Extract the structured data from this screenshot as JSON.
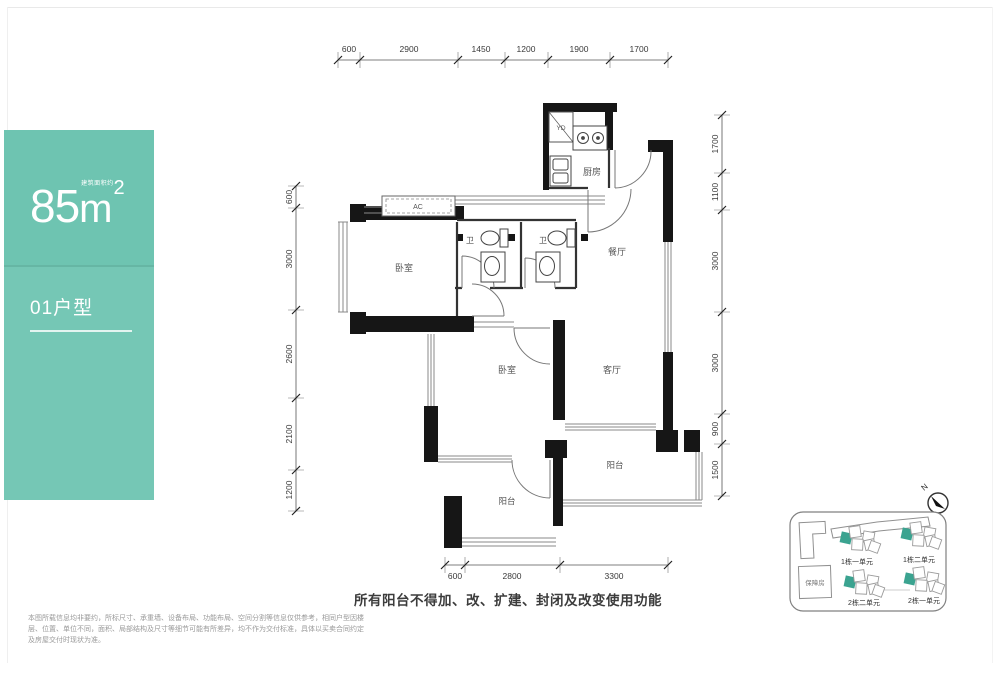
{
  "panel": {
    "area_value": "85",
    "area_unit": "m",
    "area_exp": "2",
    "area_note": "建筑面积约",
    "unit_type": "01户型"
  },
  "plan": {
    "rooms": {
      "kitchen": "厨房",
      "dining": "餐厅",
      "living": "客厅",
      "bedroom_master": "卧室",
      "bedroom_second": "卧室",
      "bath_master": "卫",
      "bath_second": "卫",
      "balcony_living": "阳台",
      "balcony_bedroom": "阳台",
      "laundry": "YD",
      "ac": "AC"
    },
    "dims": {
      "top": [
        "600",
        "2900",
        "1450",
        "1200",
        "1900",
        "1700"
      ],
      "left": [
        "600",
        "3000",
        "2600",
        "2100",
        "1200"
      ],
      "right": [
        "1700",
        "1100",
        "3000",
        "3000",
        "900",
        "1500"
      ],
      "bottom": [
        "600",
        "2800",
        "3300"
      ]
    }
  },
  "notes": {
    "balcony_rule": "所有阳台不得加、改、扩建、封闭及改变使用功能",
    "disclaimer": "本图所载信息均非要约，所标尺寸、承重墙、设备布局、功能布局、空间分割等信息仅供参考，相同户型因楼层、位置、单位不同，面积、局部结构及尺寸等细节可能有所差异，均不作为交付标准，具体以买卖合同约定及房屋交付时现状为准。"
  },
  "sitemap": {
    "compass": "N",
    "building_1_unit_1": "1栋一单元",
    "building_1_unit_2": "1栋二单元",
    "building_2_unit_2": "2栋二单元",
    "building_2_unit_1": "2栋一单元",
    "support_housing": "保障房"
  },
  "colors": {
    "panel_teal": "#6EC4B1",
    "unit_highlight": "#3BA390",
    "wall_black": "#161616"
  }
}
